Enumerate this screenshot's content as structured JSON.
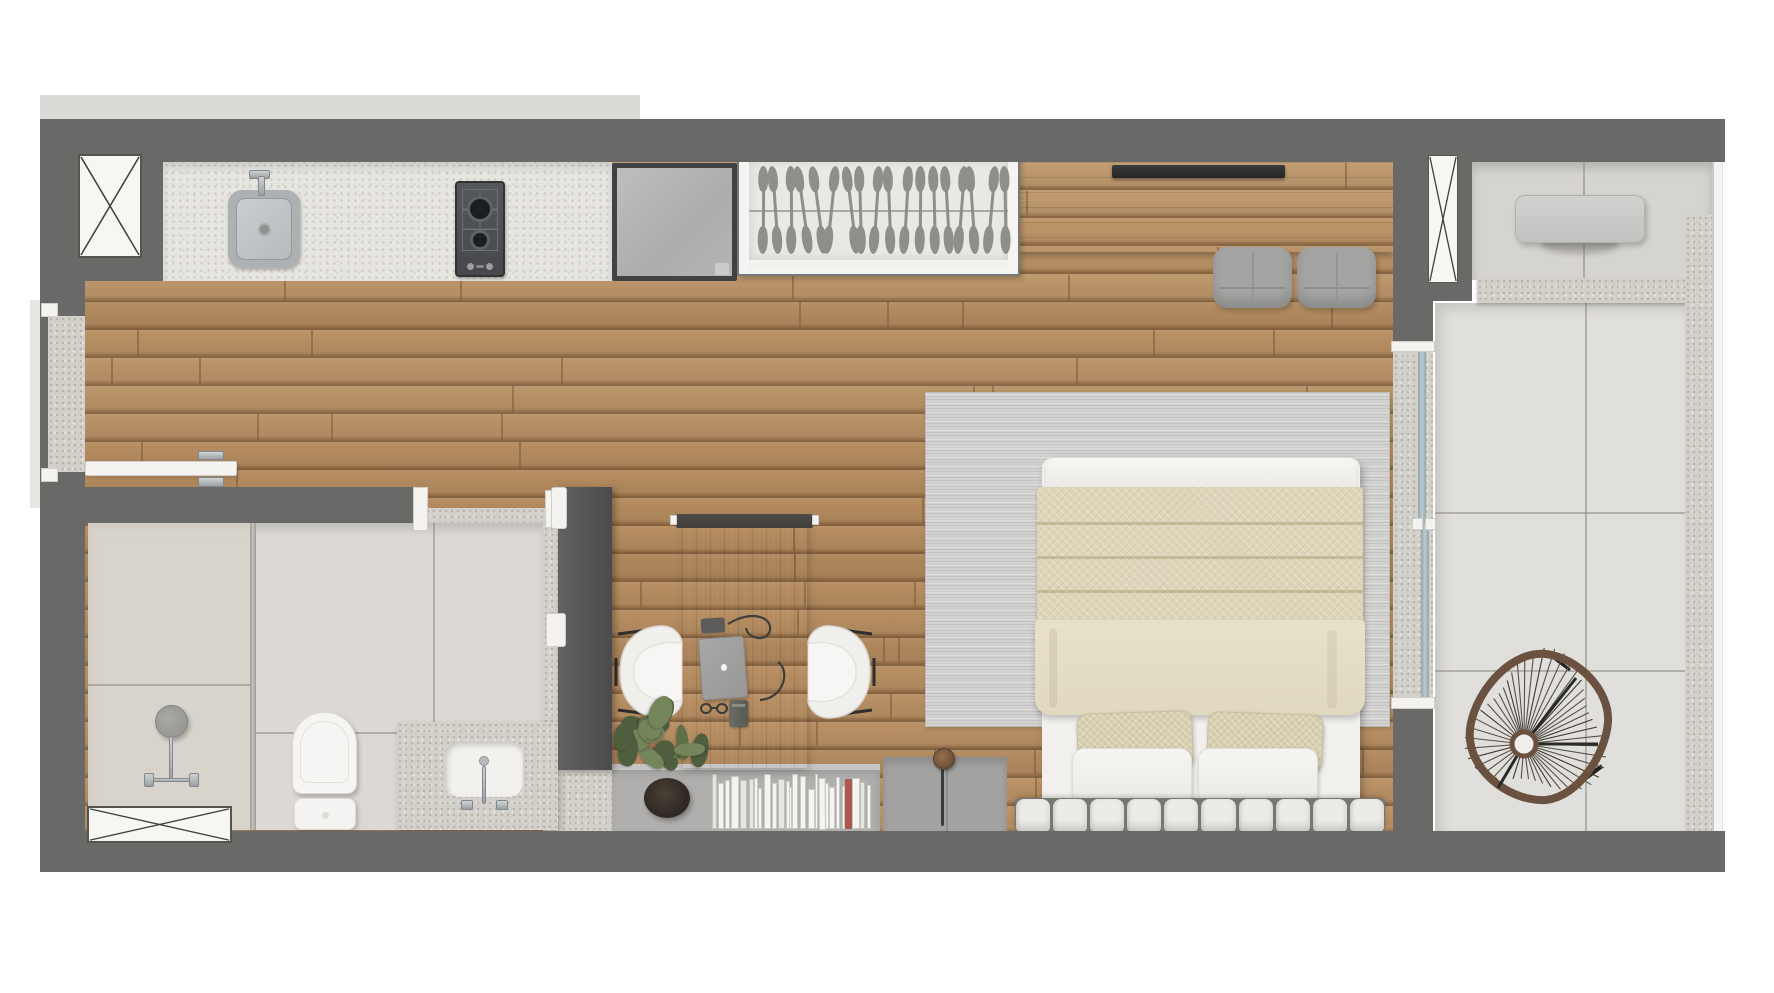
{
  "meta": {
    "description": "Top-down 3D rendered architectural floor plan of a studio apartment with kitchen, bathroom, living-bedroom area and balcony",
    "canvas": {
      "width": 1774,
      "height": 993
    }
  },
  "rooms": [
    {
      "id": "kitchen",
      "semantic": "kitchen-strip",
      "features": [
        "granite-counter",
        "sink",
        "gas-cooktop",
        "refrigerator"
      ]
    },
    {
      "id": "wardrobe",
      "semantic": "built-in-wardrobe",
      "features": [
        "hanger-rod",
        "hangers"
      ]
    },
    {
      "id": "living-bedroom",
      "semantic": "main-room",
      "features": [
        "media-counter",
        "tv",
        "poufs",
        "desk",
        "chairs",
        "bookshelf",
        "bed",
        "rug",
        "floor-lamp"
      ]
    },
    {
      "id": "bathroom",
      "semantic": "bathroom",
      "features": [
        "shower",
        "glass-partition",
        "toilet",
        "vanity-sink",
        "sliding-door"
      ]
    },
    {
      "id": "balcony",
      "semantic": "balcony-terrace",
      "features": [
        "table",
        "acapulco-chair",
        "granite-planter-edge",
        "glass-railing",
        "sliding-glass-door"
      ]
    },
    {
      "id": "entry",
      "semantic": "entry",
      "features": [
        "open-door-leaf",
        "granite-threshold"
      ]
    }
  ],
  "palette": {
    "wall": "#696968",
    "ledge": "#dbdad7",
    "floor_wood": "#b38a5e",
    "plank_seam": "#7c5a39",
    "counter_granite": "#e7e5e0",
    "bath_tile": "#dcd9d5",
    "shower_tile": "#d7d2c8",
    "balcony_tile_upper": "#d6d4cf",
    "balcony_tile_main": "#e1dfdb",
    "granite_band": "#cbc8c1",
    "wardrobe_inner": "#eae8e3",
    "hanger": "#8e8e8b",
    "fridge": "#b4b6b8",
    "tv": "#292b2d",
    "pouf": "#a4a4a2",
    "media_wood_dark": "#7b5f43",
    "desk_wood": "#755840",
    "chair_white": "#f0efec",
    "shelf_gray": "#b0afad",
    "cabinet_gray": "#a3a3a1",
    "rug": "#d3d2d0",
    "quilt_beige": "#dcd5b9",
    "duvet_beige": "#e6dfc8",
    "pillow_beige": "#d8d0b0",
    "soft_white": "#f2f1ee",
    "headboard_white": "#ecebe8",
    "glass": "#aebcc3",
    "chrome": "#b9bcbe",
    "lamp_bronze": "#7c5b41",
    "plant_greens": [
      "#5f7048",
      "#74855c",
      "#4e5e3e"
    ],
    "plant_pot": "#3a332b",
    "acapulco_frame": "#6b5240",
    "acapulco_string": "#55504a",
    "book_white": "#f5f4f1",
    "book_accent": "#b2564a",
    "book_dark": "#6f6e6a"
  },
  "decor": {
    "wardrobe_hangers": 18,
    "books_left": 13,
    "books_right": 14,
    "headboard_channels": 10,
    "acapulco_spokes": 46,
    "plank_rows": 24,
    "plank_seams_per_row": 4,
    "foliage_blobs": 18
  }
}
